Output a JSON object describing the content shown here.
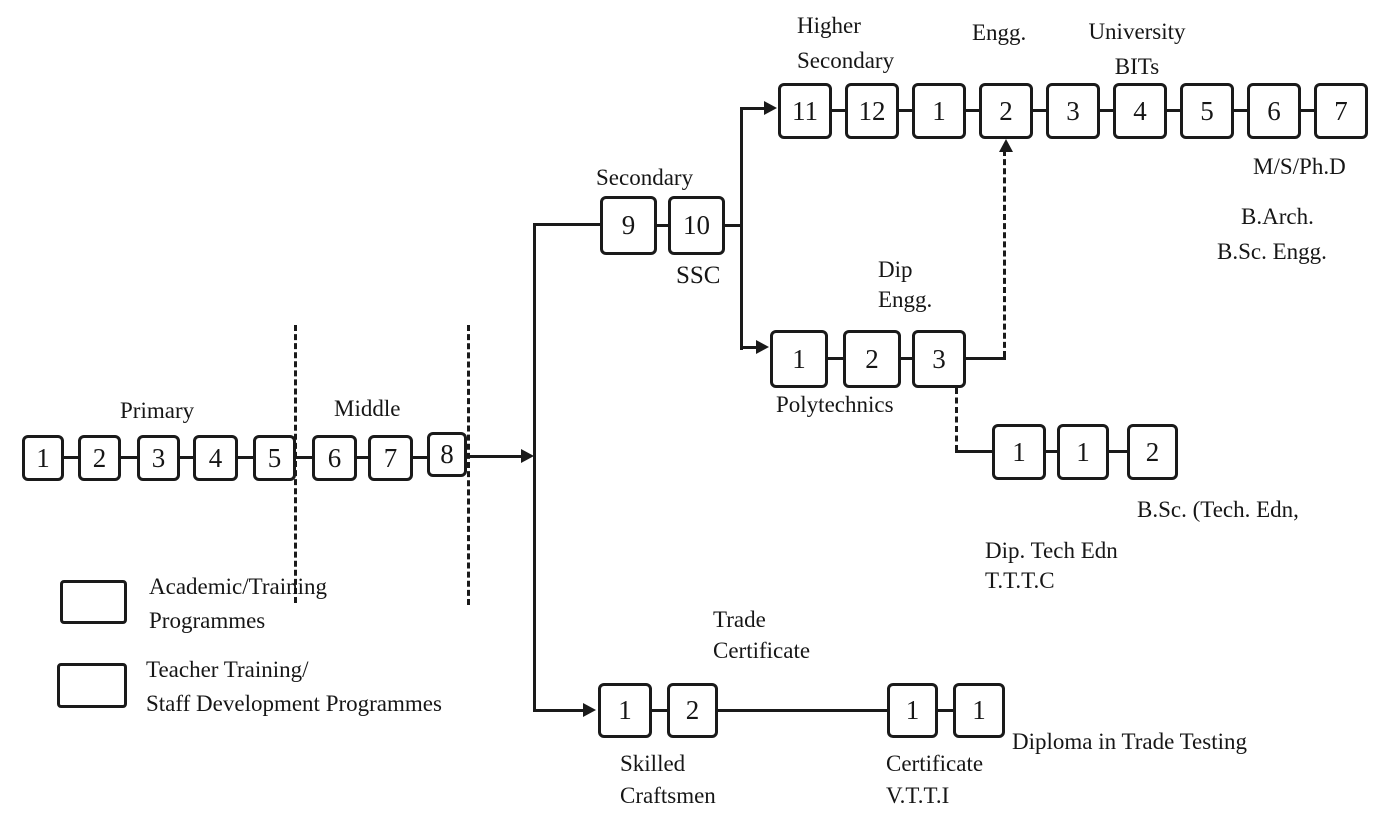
{
  "colors": {
    "ink": "#1a1a1a",
    "background": "#ffffff"
  },
  "legend": {
    "item1_line1": "Academic/Training",
    "item1_line2": "Programmes",
    "item2_line1": "Teacher Training/",
    "item2_line2": "Staff Development Programmes"
  },
  "primary": {
    "label": "Primary",
    "boxes": [
      "1",
      "2",
      "3",
      "4",
      "5"
    ]
  },
  "middle": {
    "label": "Middle",
    "boxes": [
      "6",
      "7",
      "8"
    ]
  },
  "secondary": {
    "label": "Secondary",
    "exam": "SSC",
    "boxes": [
      "9",
      "10"
    ]
  },
  "higher_secondary": {
    "line1": "Higher",
    "line2": "Secondary"
  },
  "university": {
    "engg_label": "Engg.",
    "line1": "University",
    "line2": "BITs",
    "boxes": [
      "11",
      "12",
      "1",
      "2",
      "3",
      "4",
      "5",
      "6",
      "7"
    ],
    "outcome1": "M/S/Ph.D",
    "outcome2": "B.Arch.",
    "outcome3": "B.Sc. Engg."
  },
  "polytechnic": {
    "dip_line1": "Dip",
    "dip_line2": "Engg.",
    "label": "Polytechnics",
    "boxes": [
      "1",
      "2",
      "3"
    ]
  },
  "tech_education": {
    "boxes": [
      "1",
      "1",
      "2"
    ],
    "outcome": "B.Sc. (Tech. Edn,",
    "line1": "Dip. Tech Edn",
    "line2": "T.T.T.C"
  },
  "skilled": {
    "cert_line1": "Trade",
    "cert_line2": "Certificate",
    "boxes": [
      "1",
      "2"
    ],
    "line1": "Skilled",
    "line2": "Craftsmen"
  },
  "vtti": {
    "boxes": [
      "1",
      "1"
    ],
    "line1": "Certificate",
    "line2": "V.T.T.I",
    "outcome": "Diploma in Trade Testing"
  }
}
